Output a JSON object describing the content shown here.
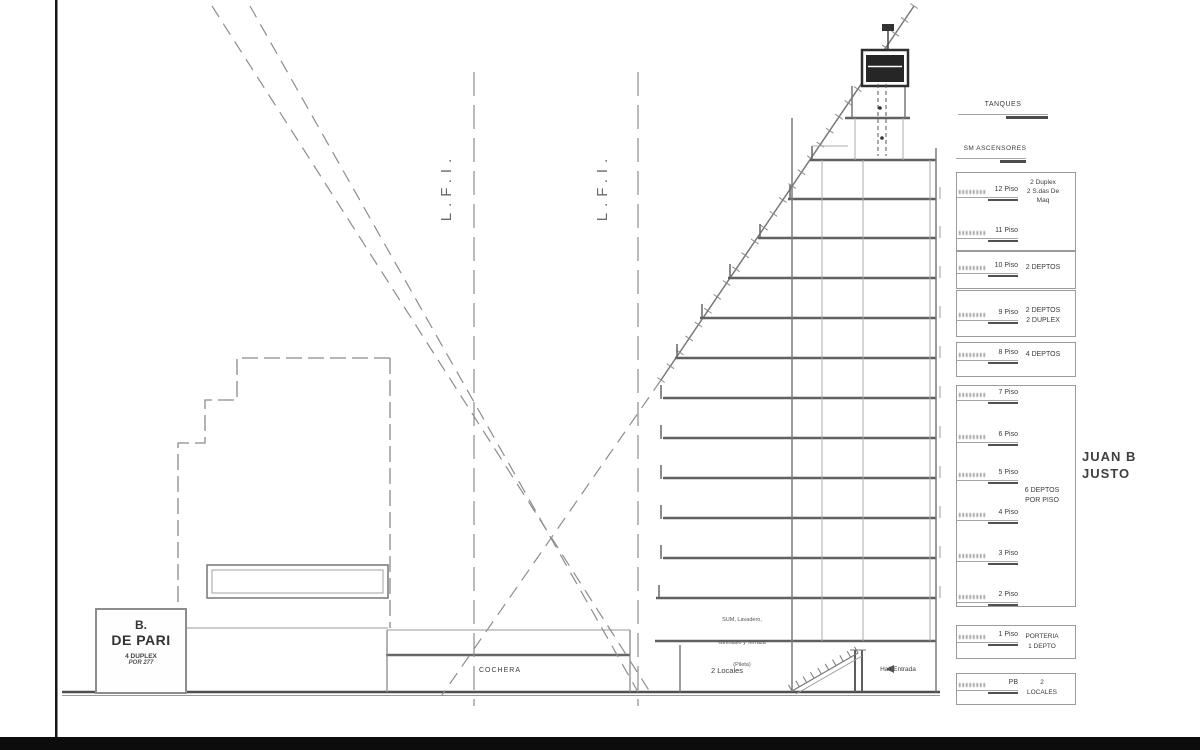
{
  "palette": {
    "ink": "#3d3d3d",
    "line": "#777777",
    "frame": "#0c0c0c"
  },
  "left_building": {
    "name_line1": "B.",
    "name_line2": "DE PARI",
    "detail_line1": "4 DUPLEX",
    "detail_line2": "POR 277"
  },
  "lot_lines": {
    "left_label": "L.F.I.",
    "right_label": "L.F.I."
  },
  "ground_floor": {
    "cochera": "COCHERA",
    "locales": "2 Locales",
    "hall": "Hall Entrada"
  },
  "amenities": {
    "line1": "SUM, Lavadero,",
    "line2": "Gimnasio y Terraza",
    "line3": "(Pileta)"
  },
  "roof_callouts": {
    "tanques": "TANQUES",
    "ascensores": "SM ASCENSORES"
  },
  "street": {
    "line1": "JUAN B",
    "line2": "JUSTO"
  },
  "floor_table": {
    "rows": [
      {
        "label": "12 Piso"
      },
      {
        "label": "11 Piso"
      },
      {
        "label": "10 Piso"
      },
      {
        "label": "9 Piso"
      },
      {
        "label": "8 Piso"
      },
      {
        "label": "7 Piso"
      },
      {
        "label": "6 Piso"
      },
      {
        "label": "5 Piso"
      },
      {
        "label": "4 Piso"
      },
      {
        "label": "3 Piso"
      },
      {
        "label": "2 Piso"
      },
      {
        "label": "1 Piso"
      },
      {
        "label": "PB"
      }
    ],
    "notes": {
      "floors_12_11_l1": "2 Duplex",
      "floors_12_11_l2": "2 S.das De",
      "floors_12_11_l3": "Maq",
      "floor_10": "2 DEPTOS",
      "floor_9_l1": "2 DEPTOS",
      "floor_9_l2": "2 DUPLEX",
      "floor_8": "4 DEPTOS",
      "floors_7_2_l1": "6 DEPTOS",
      "floors_7_2_l2": "POR PISO",
      "floor_1_l1": "PORTERIA",
      "floor_1_l2": "1 DEPTO",
      "pb_l1": "2",
      "pb_l2": "LOCALES"
    }
  }
}
